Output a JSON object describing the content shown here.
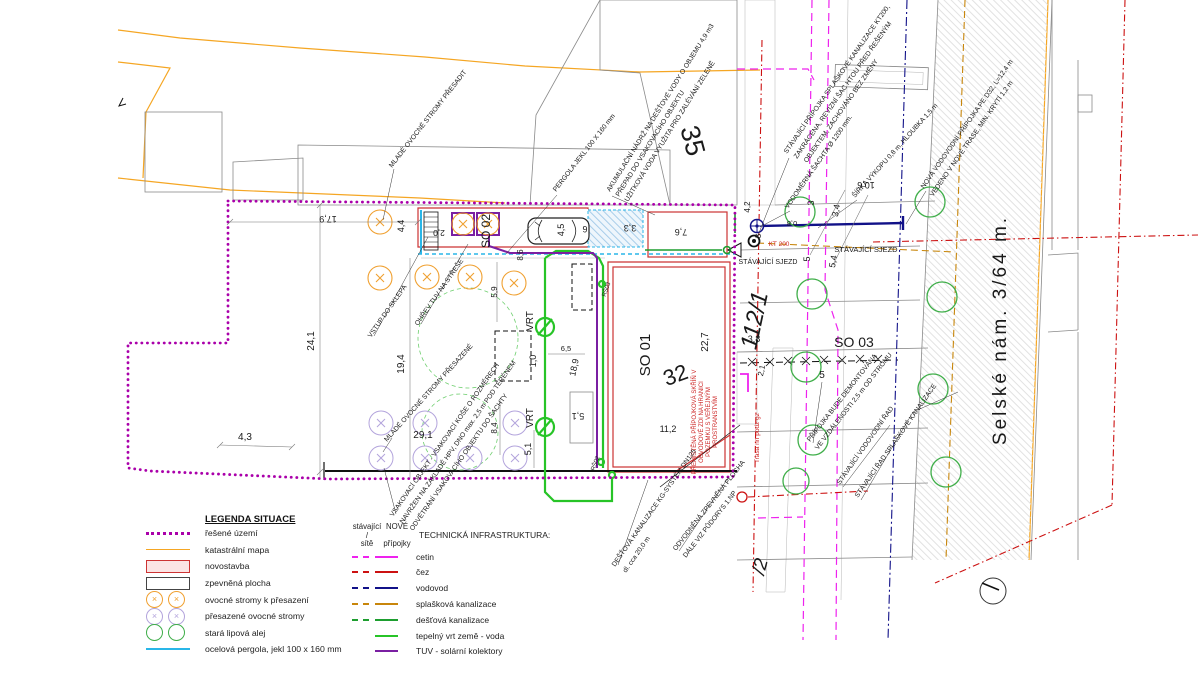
{
  "colors": {
    "bound": "#aa00aa",
    "katastr": "#f5a623",
    "novostavba": "#cc3333",
    "novostavba-fill": "#fbe4e4",
    "pergola": "#29b6e8",
    "cetin": "#ee22ee",
    "cez": "#cc1111",
    "vodovod": "#111188",
    "splaskova": "#c8860b",
    "destova": "#1d9e2f",
    "vrt": "#27c427",
    "tuv": "#7a1fa2",
    "tree-orange": "#f0a030",
    "tree-violet": "#b3a4dc",
    "tree-green": "#3fae49",
    "street-text": "#5a5a5a",
    "red-note": "#cc2222"
  },
  "legend": {
    "title": "LEGENDA SITUACE",
    "items": [
      {
        "label": "řešené území"
      },
      {
        "label": "katastrální mapa"
      },
      {
        "label": "novostavba"
      },
      {
        "label": "zpevněná plocha"
      },
      {
        "label": "ovocné stromy k přesazení",
        "mark": "×"
      },
      {
        "label": "přesazené ovocné stromy",
        "mark": "×"
      },
      {
        "label": "stará lipová alej"
      },
      {
        "label": "ocelová pergola, jekl 100 x 160 mm"
      }
    ]
  },
  "infra": {
    "head_existing_1": "stávající /",
    "head_existing_2": "sítě",
    "head_new_1": "NOVÉ",
    "head_new_2": "přípojky",
    "title": "TECHNICKÁ INFRASTRUKTURA:",
    "items": [
      {
        "label": "cetin"
      },
      {
        "label": "čez"
      },
      {
        "label": "vodovod"
      },
      {
        "label": "splašková kanalizace"
      },
      {
        "label": "dešťová kanalizace"
      },
      {
        "label": "tepelný vrt země - voda"
      },
      {
        "label": "TUV - solární kolektory"
      }
    ]
  },
  "plan": {
    "parcels": {
      "p35": "35",
      "p32": "32",
      "p112": "112/1",
      "p2": "/2"
    },
    "objects": {
      "so01": "SO 01",
      "so02": "SO 02",
      "so03": "SO 03"
    },
    "street": "Selské nám.  3/64 m.",
    "labels": {
      "sjezd1": "STÁVAJÍCÍ SJEZD",
      "sjezd2": "STÁVAJÍCÍ SJEZD",
      "kt": "KT 200",
      "vrt1": "VRT",
      "vrt2": "VRT",
      "rs02": "RŠ02",
      "rs03": "RŠ03",
      "trasa": "Trasa nn podz gz"
    },
    "dims": {
      "d17_9": "17,9",
      "d4_4": "4,4",
      "d2_0": "2,0",
      "d24_1": "24,1",
      "d19_4": "19,4",
      "d4_3": "4,3",
      "d29_1": "29,1",
      "d5_9": "5,9",
      "d8_4": "8,4",
      "d5_1a": "5,1",
      "d5_1b": "5,1",
      "d1_0": "1,0",
      "d6_5": "6,5",
      "d18_9": "18,9",
      "d4_5": "4,5",
      "d6": "6",
      "d8_6": "8,6",
      "d3_3": "3,3",
      "d7_6": "7,6",
      "d22_7": "22,7",
      "d11_2": "11,2",
      "d3_8": "3,8",
      "d2_1": "2,1",
      "d5a": "5",
      "d5b": "5",
      "d5_4": "5,4",
      "d3a": "3",
      "d3_4": "3,4",
      "d10_6": "10,6",
      "d4_2": "4,2",
      "d3b": "3",
      "d0_8": "0,8"
    },
    "annotations": {
      "a1": "MLADÉ OVOCNÉ STROMY PŘESADIT",
      "a2": "PERGOLA JEKL 100 X 160 mm",
      "a3_1": "AKUMULAČNÍ NÁDRŽ NA DEŠŤOVÉ VODY O OBJEMU 4,9 m3",
      "a3_2": "PŘEPAD DO VSAKOVACÍHO OBJEKTU",
      "a3_3": "UŽITKOVÁ VODA VYUŽITA PRO ZALÉVÁNÍ ZELENĚ",
      "a4_1": "STÁVAJÍCÍ PŘÍPOJKA SPLAŠKOVÉ KANALIZACE KT200,",
      "a4_2": "ZAKRÁCENA, REVIZNÍ ŠAC HTOU PŘED ŘEŠENÝM",
      "a4_3": "OBJEKTEM, ZACHOVÁNO BEZ ZMĚNY",
      "a5": "VODOMĚRNÁ ŠACHTA Ø 1200 mm.",
      "a6": "ŠÍŘKA VÝKOPU 0,8 m, HLOUBKA 1,5 m",
      "a7_1": "NOVÁ VODOVODNÍ PŘÍPOJKA PE D32, L=12,4 m",
      "a7_2": "VEDENO V NOVÉ TRASE, MIN. KRYTÍ 1,2 m",
      "a8": "VSTUP DO SKLEPA",
      "a9": "OHŘEV TUV NA STŘEŠE",
      "a10": "MLADÉ OVOCNÉ STROMY PŘESAZENÉ",
      "a11_1": "VSAKOVACÍ OBJEKT - VSAKOVACÍ KOŠE O ROZMĚRECH",
      "a11_2": "NAVRŽEN NA ZÁKLADĚ HPV, DNO max. 2,5 m POD TERÉNEM",
      "a11_3": "ODVĚTRÁNÍ VSAKOVACÍHO OBJEKTU DO ŠACHTY",
      "a12_1": "DEŠŤOVÁ KANALIZACE KG-SYSTÉM DN125",
      "a12_2": "dl. cca 20,0 m",
      "a13_1": "ODVODNĚNÁ ZPEVNĚNÁ PLOCHA",
      "a13_2": "DÁLE VIZ PŮDORYS 1.NP",
      "a14_1": "PŘÍPOJKA BUDE DEMONTOVÁNA",
      "a14_2": "VE VZDÁLENOSTI 2,5 m OD STROMU",
      "a15": "STÁVAJÍCÍ VODOVODNÍ ŘAD",
      "a16": "STÁVAJÍCÍ ŘAD SPLAŠKOVÉ KANALIZACE"
    },
    "red_note": [
      "PŘEMÍSTĚNÁ PŘÍPOJKOVÁ SKŘÍŇ V",
      "OBVODOVÉ ZDI NA HRANICI",
      "POZEMKU S VEŘEJNÝM",
      "PROSTRANSTVÍM"
    ]
  }
}
